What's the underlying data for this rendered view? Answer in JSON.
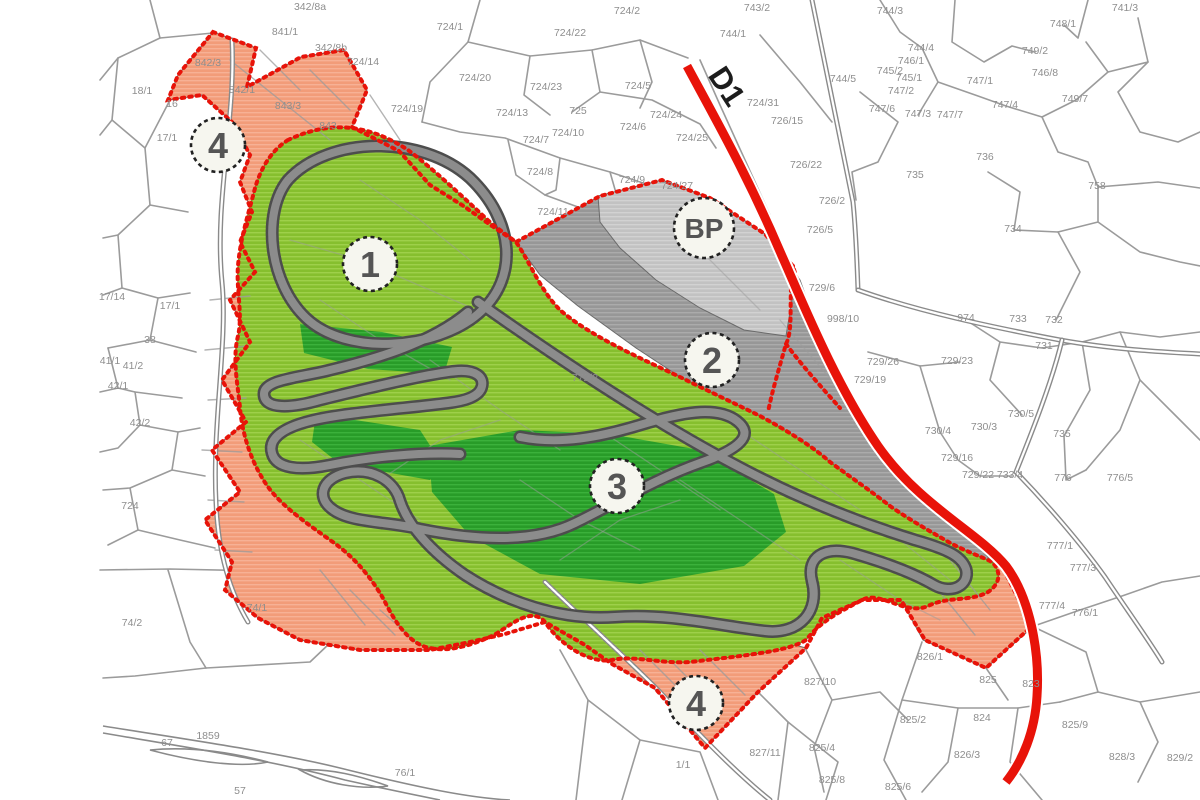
{
  "map": {
    "title": "cadastral zoning plan with race circuit",
    "colors": {
      "red": "#e81309",
      "light_green": "#8cc434",
      "dark_green": "#2ea32e",
      "salmon": "#f2a07d",
      "gray_zone": "#9d9d9d",
      "bp_zone": "#c6c6c6",
      "track_gray": "#8c8c8c",
      "track_edge": "#4d4d4d",
      "parcel_line": "#9b9b9b",
      "label_gray": "#8e8e8e"
    },
    "road_label": {
      "text": "D1",
      "x": 718,
      "y": 92,
      "rotation": 57
    },
    "zone_markers": [
      {
        "label": "4",
        "x": 218,
        "y": 145,
        "r": 27
      },
      {
        "label": "1",
        "x": 370,
        "y": 264,
        "r": 27
      },
      {
        "label": "2",
        "x": 712,
        "y": 360,
        "r": 27
      },
      {
        "label": "3",
        "x": 617,
        "y": 486,
        "r": 27
      },
      {
        "label": "4",
        "x": 696,
        "y": 703,
        "r": 27
      },
      {
        "label": "BP",
        "x": 704,
        "y": 228,
        "r": 30
      }
    ],
    "parcel_labels": [
      {
        "t": "342/8a",
        "x": 310,
        "y": 6
      },
      {
        "t": "342/8b",
        "x": 331,
        "y": 47
      },
      {
        "t": "841/1",
        "x": 285,
        "y": 31
      },
      {
        "t": "724/14",
        "x": 363,
        "y": 61
      },
      {
        "t": "18/1",
        "x": 142,
        "y": 90
      },
      {
        "t": "842/3",
        "x": 208,
        "y": 62
      },
      {
        "t": "842/1",
        "x": 242,
        "y": 89
      },
      {
        "t": "843/3",
        "x": 288,
        "y": 105
      },
      {
        "t": "843",
        "x": 328,
        "y": 125
      },
      {
        "t": "16",
        "x": 172,
        "y": 103
      },
      {
        "t": "17/1",
        "x": 167,
        "y": 137
      },
      {
        "t": "17/14",
        "x": 112,
        "y": 296
      },
      {
        "t": "17/1",
        "x": 170,
        "y": 305
      },
      {
        "t": "38",
        "x": 150,
        "y": 339
      },
      {
        "t": "41/1",
        "x": 110,
        "y": 360
      },
      {
        "t": "41/2",
        "x": 133,
        "y": 365
      },
      {
        "t": "42/1",
        "x": 118,
        "y": 385
      },
      {
        "t": "42/2",
        "x": 140,
        "y": 422
      },
      {
        "t": "724",
        "x": 130,
        "y": 505
      },
      {
        "t": "74/2",
        "x": 132,
        "y": 622
      },
      {
        "t": "74/1",
        "x": 257,
        "y": 607
      },
      {
        "t": "67",
        "x": 167,
        "y": 742
      },
      {
        "t": "1859",
        "x": 208,
        "y": 735
      },
      {
        "t": "57",
        "x": 240,
        "y": 790
      },
      {
        "t": "76/1",
        "x": 405,
        "y": 772
      },
      {
        "t": "724/1",
        "x": 450,
        "y": 26
      },
      {
        "t": "724/22",
        "x": 570,
        "y": 32
      },
      {
        "t": "724/2",
        "x": 627,
        "y": 10
      },
      {
        "t": "724/20",
        "x": 475,
        "y": 77
      },
      {
        "t": "724/23",
        "x": 546,
        "y": 86
      },
      {
        "t": "724/19",
        "x": 407,
        "y": 108
      },
      {
        "t": "724/13",
        "x": 512,
        "y": 112
      },
      {
        "t": "725",
        "x": 578,
        "y": 110
      },
      {
        "t": "724/5",
        "x": 638,
        "y": 85
      },
      {
        "t": "724/10",
        "x": 568,
        "y": 132
      },
      {
        "t": "724/6",
        "x": 633,
        "y": 126
      },
      {
        "t": "724/7",
        "x": 536,
        "y": 139
      },
      {
        "t": "724/8",
        "x": 540,
        "y": 171
      },
      {
        "t": "724/9",
        "x": 632,
        "y": 179
      },
      {
        "t": "724/27",
        "x": 677,
        "y": 185
      },
      {
        "t": "724/11",
        "x": 553,
        "y": 211
      },
      {
        "t": "724/24",
        "x": 666,
        "y": 114
      },
      {
        "t": "724/25",
        "x": 692,
        "y": 137
      },
      {
        "t": "724/31",
        "x": 763,
        "y": 102
      },
      {
        "t": "726/15",
        "x": 787,
        "y": 120
      },
      {
        "t": "726/22",
        "x": 806,
        "y": 164
      },
      {
        "t": "726/5",
        "x": 820,
        "y": 229
      },
      {
        "t": "726/2",
        "x": 832,
        "y": 200
      },
      {
        "t": "744/1",
        "x": 733,
        "y": 33
      },
      {
        "t": "743/2",
        "x": 757,
        "y": 7
      },
      {
        "t": "744/3",
        "x": 890,
        "y": 10
      },
      {
        "t": "744/4",
        "x": 921,
        "y": 47
      },
      {
        "t": "744/5",
        "x": 843,
        "y": 78
      },
      {
        "t": "746/1",
        "x": 911,
        "y": 60
      },
      {
        "t": "745/2",
        "x": 890,
        "y": 70
      },
      {
        "t": "745/1",
        "x": 909,
        "y": 77
      },
      {
        "t": "747/2",
        "x": 901,
        "y": 90
      },
      {
        "t": "747/6",
        "x": 882,
        "y": 108
      },
      {
        "t": "747/3",
        "x": 918,
        "y": 113
      },
      {
        "t": "747/7",
        "x": 950,
        "y": 114
      },
      {
        "t": "747/1",
        "x": 980,
        "y": 80
      },
      {
        "t": "747/4",
        "x": 1005,
        "y": 104
      },
      {
        "t": "749/2",
        "x": 1035,
        "y": 50
      },
      {
        "t": "746/8",
        "x": 1045,
        "y": 72
      },
      {
        "t": "749/7",
        "x": 1075,
        "y": 98
      },
      {
        "t": "748/1",
        "x": 1063,
        "y": 23
      },
      {
        "t": "741/3",
        "x": 1125,
        "y": 7
      },
      {
        "t": "736",
        "x": 985,
        "y": 156
      },
      {
        "t": "735",
        "x": 915,
        "y": 174
      },
      {
        "t": "734",
        "x": 1013,
        "y": 228
      },
      {
        "t": "758",
        "x": 1097,
        "y": 185
      },
      {
        "t": "998/10",
        "x": 843,
        "y": 318
      },
      {
        "t": "729/6",
        "x": 822,
        "y": 287
      },
      {
        "t": "729/26",
        "x": 883,
        "y": 361
      },
      {
        "t": "729/19",
        "x": 870,
        "y": 379
      },
      {
        "t": "729/23",
        "x": 957,
        "y": 360
      },
      {
        "t": "730/5",
        "x": 1021,
        "y": 413
      },
      {
        "t": "730/3",
        "x": 984,
        "y": 426
      },
      {
        "t": "730/4",
        "x": 938,
        "y": 430
      },
      {
        "t": "729/16",
        "x": 957,
        "y": 457
      },
      {
        "t": "729/22",
        "x": 978,
        "y": 474
      },
      {
        "t": "733/4",
        "x": 1010,
        "y": 474
      },
      {
        "t": "731",
        "x": 1044,
        "y": 345
      },
      {
        "t": "732",
        "x": 1054,
        "y": 319
      },
      {
        "t": "733",
        "x": 1018,
        "y": 318
      },
      {
        "t": "974",
        "x": 966,
        "y": 317
      },
      {
        "t": "735",
        "x": 1062,
        "y": 433
      },
      {
        "t": "776",
        "x": 1063,
        "y": 477
      },
      {
        "t": "776/5",
        "x": 1120,
        "y": 477
      },
      {
        "t": "777/1",
        "x": 1060,
        "y": 545
      },
      {
        "t": "777/3",
        "x": 1083,
        "y": 567
      },
      {
        "t": "777/4",
        "x": 1052,
        "y": 605
      },
      {
        "t": "776/1",
        "x": 1085,
        "y": 612
      },
      {
        "t": "1/1",
        "x": 683,
        "y": 764
      },
      {
        "t": "827/11",
        "x": 765,
        "y": 752
      },
      {
        "t": "827/10",
        "x": 820,
        "y": 681
      },
      {
        "t": "826/1",
        "x": 930,
        "y": 656
      },
      {
        "t": "825",
        "x": 988,
        "y": 679
      },
      {
        "t": "824",
        "x": 982,
        "y": 717
      },
      {
        "t": "825/2",
        "x": 913,
        "y": 719
      },
      {
        "t": "826/3",
        "x": 967,
        "y": 754
      },
      {
        "t": "825/9",
        "x": 1075,
        "y": 724
      },
      {
        "t": "825/8",
        "x": 832,
        "y": 779
      },
      {
        "t": "825/6",
        "x": 898,
        "y": 786
      },
      {
        "t": "823",
        "x": 1031,
        "y": 683
      },
      {
        "t": "828/3",
        "x": 1122,
        "y": 756
      },
      {
        "t": "829/2",
        "x": 1180,
        "y": 757
      },
      {
        "t": "825/4",
        "x": 822,
        "y": 747
      },
      {
        "t": "772/2",
        "x": 585,
        "y": 377
      }
    ]
  }
}
